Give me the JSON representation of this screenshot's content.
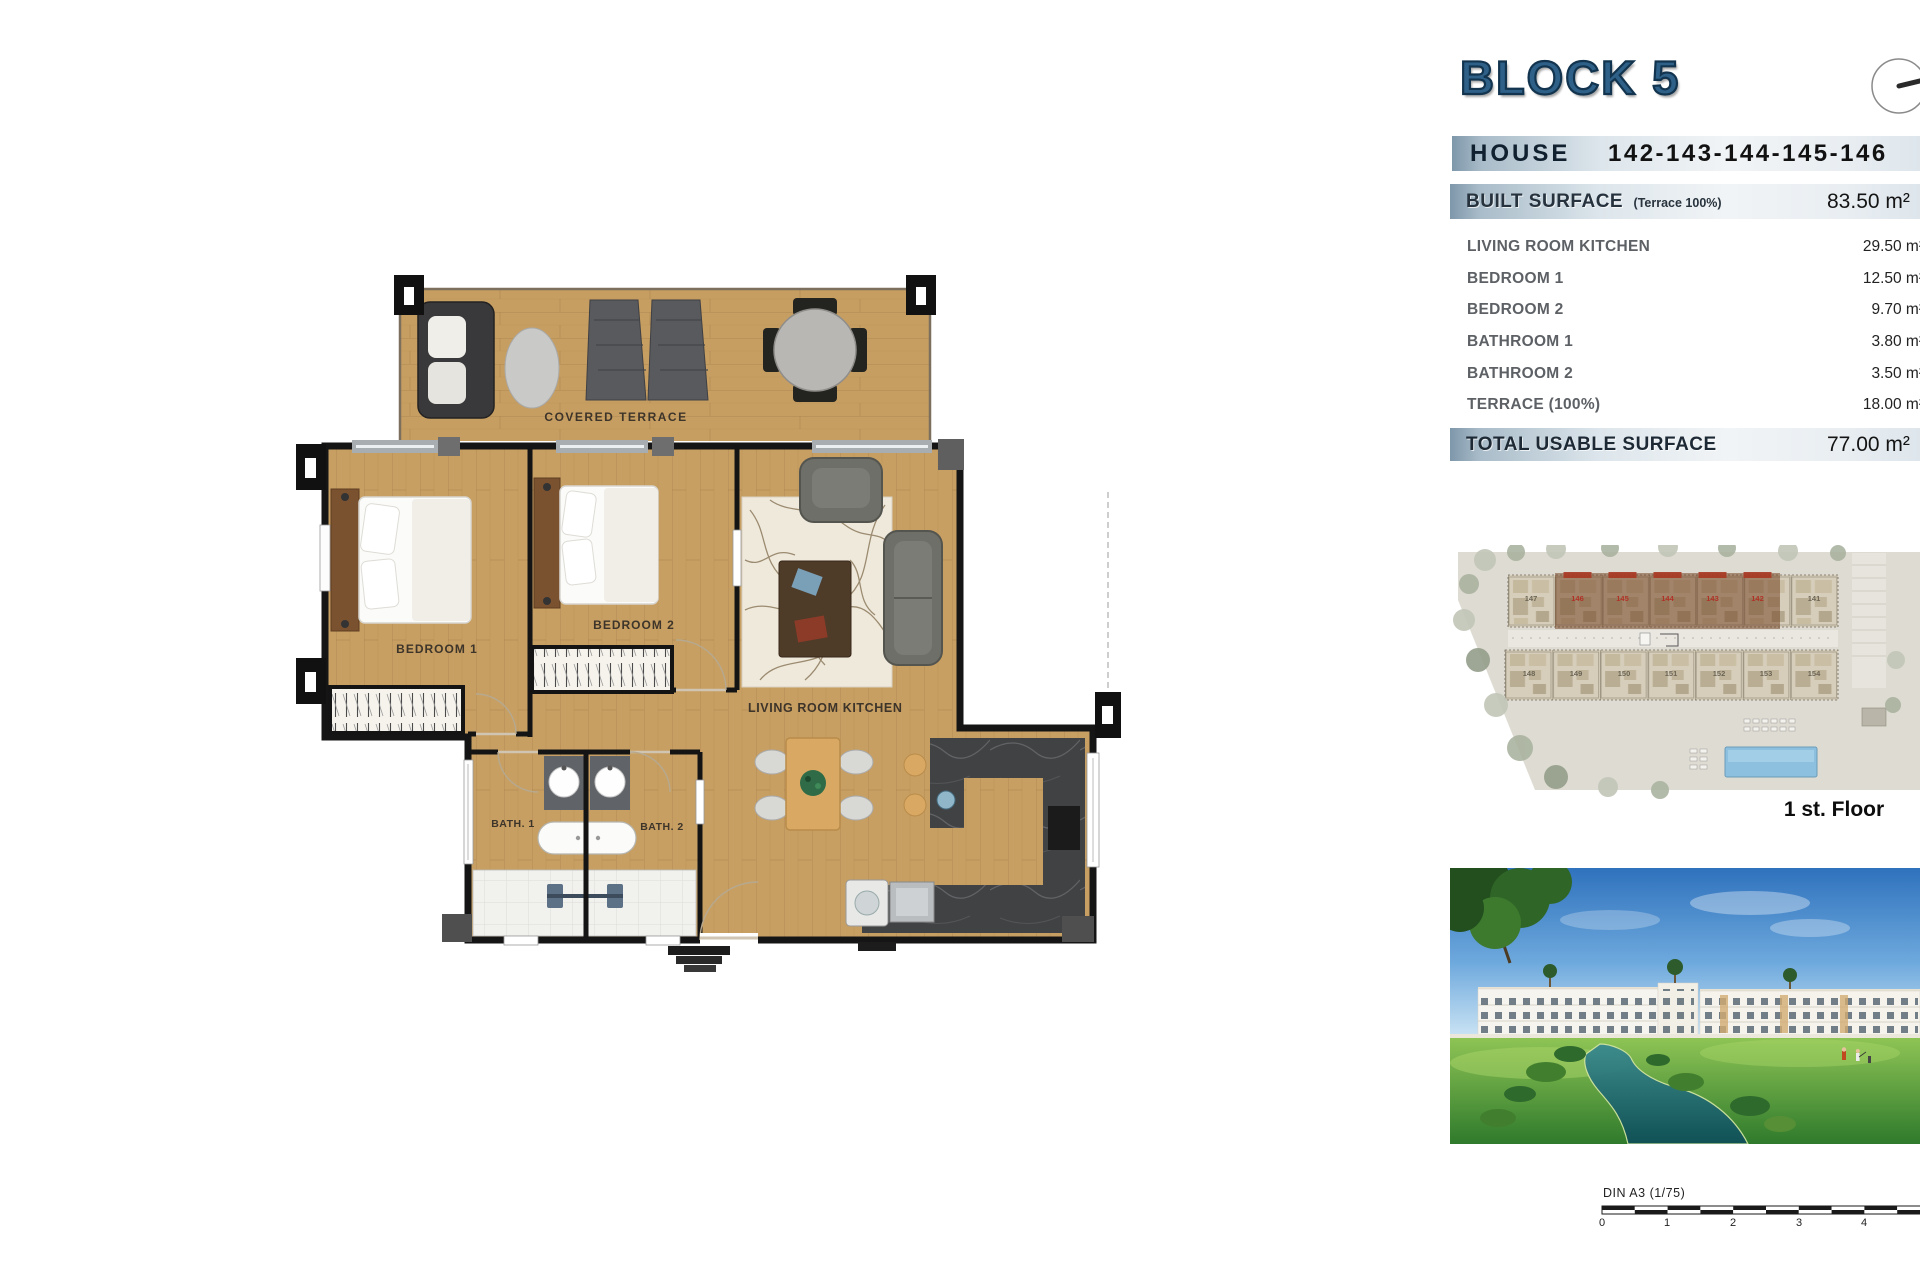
{
  "header": {
    "title": "BLOCK 5"
  },
  "house": {
    "label": "HOUSE",
    "numbers": "142-143-144-145-146"
  },
  "table": {
    "built_label": "BUILT SURFACE",
    "built_sub": "(Terrace 100%)",
    "built_value": "83.50 m²",
    "rows": [
      {
        "label": "LIVING ROOM KITCHEN",
        "value": "29.50 m²"
      },
      {
        "label": "BEDROOM 1",
        "value": "12.50 m²"
      },
      {
        "label": "BEDROOM 2",
        "value": "9.70 m²"
      },
      {
        "label": "BATHROOM 1",
        "value": "3.80 m²"
      },
      {
        "label": "BATHROOM 2",
        "value": "3.50 m²"
      },
      {
        "label": "TERRACE (100%)",
        "value": "18.00 m²"
      }
    ],
    "total_label": "TOTAL USABLE SURFACE",
    "total_value": "77.00 m²"
  },
  "plan": {
    "terrace": "COVERED TERRACE",
    "bedroom1": "BEDROOM 1",
    "bedroom2": "BEDROOM 2",
    "living": "LIVING ROOM KITCHEN",
    "bath1": "BATH. 1",
    "bath2": "BATH. 2"
  },
  "site": {
    "caption": "1 st. Floor",
    "top_units": [
      "147",
      "146",
      "145",
      "144",
      "143",
      "142",
      "141"
    ],
    "bottom_units": [
      "148",
      "149",
      "150",
      "151",
      "152",
      "153",
      "154"
    ]
  },
  "scale": {
    "label": "DIN A3 (1/75)",
    "ticks": [
      "0",
      "1",
      "2",
      "3",
      "4"
    ]
  },
  "colors": {
    "accent_blue": "#2e6088",
    "bar_gradient_left": "#7e97aa",
    "wood": "#c89f63",
    "highlight_red": "#a83722",
    "pool_blue": "#8cc0de"
  }
}
